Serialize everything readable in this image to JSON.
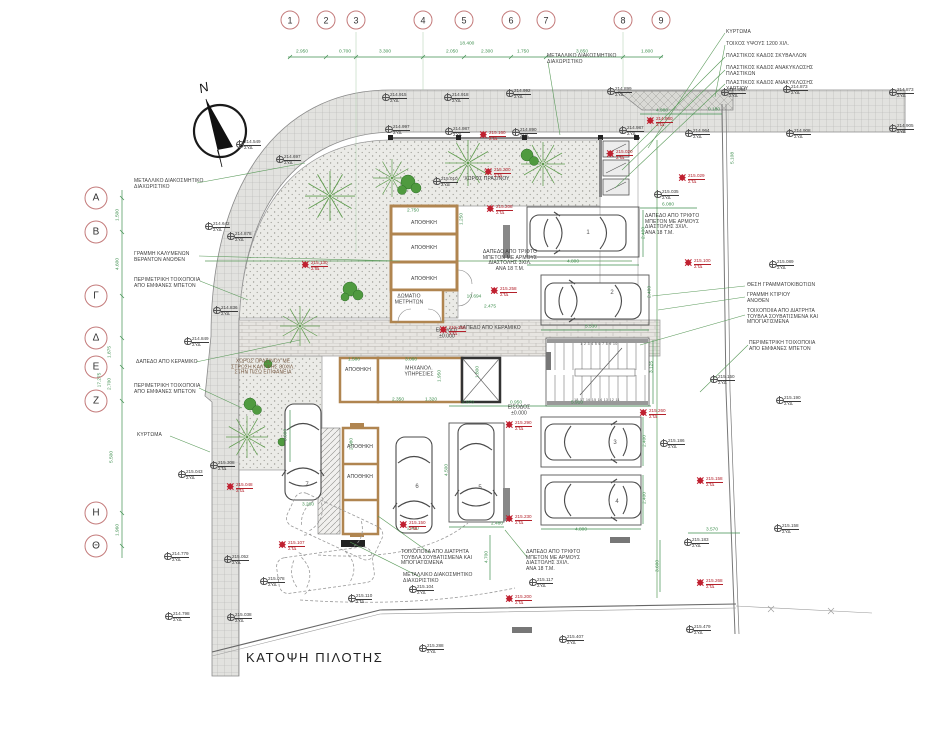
{
  "title": "ΚΑΤΟΨΗ ΠΙΛΟΤΗΣ",
  "north_label": "N",
  "colors": {
    "dim_green": "#3f8f4f",
    "marker_black": "#3a3a3a",
    "marker_red": "#b3202a",
    "bubble_red": "#c47b7b",
    "wall_tan": "#b08550"
  },
  "grid": {
    "top_bubbles": [
      {
        "label": "1",
        "x": 290
      },
      {
        "label": "2",
        "x": 326
      },
      {
        "label": "3",
        "x": 356
      },
      {
        "label": "4",
        "x": 423
      },
      {
        "label": "5",
        "x": 464
      },
      {
        "label": "6",
        "x": 511
      },
      {
        "label": "7",
        "x": 546
      },
      {
        "label": "8",
        "x": 623
      },
      {
        "label": "9",
        "x": 661
      }
    ],
    "left_bubbles": [
      {
        "label": "Α",
        "y": 198
      },
      {
        "label": "Β",
        "y": 232
      },
      {
        "label": "Γ",
        "y": 296
      },
      {
        "label": "Δ",
        "y": 338
      },
      {
        "label": "Ε",
        "y": 367
      },
      {
        "label": "Ζ",
        "y": 401
      },
      {
        "label": "Η",
        "y": 513
      },
      {
        "label": "Θ",
        "y": 546
      }
    ],
    "top_total": {
      "t": "18.400",
      "x": 467,
      "y": 44
    },
    "top_segments": [
      {
        "t": "2.950",
        "x": 302
      },
      {
        "t": "0.700",
        "x": 345
      },
      {
        "t": "3.300",
        "x": 385
      },
      {
        "t": "2.050",
        "x": 452
      },
      {
        "t": "2.300",
        "x": 487
      },
      {
        "t": "1.750",
        "x": 523
      },
      {
        "t": "3.850",
        "x": 582
      },
      {
        "t": "1.800",
        "x": 647
      }
    ],
    "left_total": {
      "t": "17.275",
      "x": 100,
      "y": 380
    },
    "left_segments": [
      {
        "t": "1.500",
        "x": 118,
        "y": 215
      },
      {
        "t": "4.600",
        "x": 118,
        "y": 264
      },
      {
        "t": "1.875",
        "x": 110,
        "y": 352
      },
      {
        "t": "2.700",
        "x": 110,
        "y": 384
      },
      {
        "t": "5.500",
        "x": 112,
        "y": 457
      },
      {
        "t": "1.960",
        "x": 118,
        "y": 530
      }
    ]
  },
  "callouts": [
    {
      "t": "ΜΕΤΑΛΛΙΚΟ ΔΙΑΚΟΣΜΗΤΙΚΟ\nΔΙΑΧΩΡΙΣΤΙΚΟ",
      "x": 134,
      "y": 179
    },
    {
      "t": "ΓΡΑΜΜΗ ΚΑΛΥΜΕΝΩΝ\nΒΕΡΑΝΤΩΝ ΑΝΩΘΕΝ",
      "x": 134,
      "y": 252
    },
    {
      "t": "ΠΕΡΙΜΕΤΡΙΚΗ ΤΟΙΧΟΠΟΙΙΑ\nΑΠΟ ΕΜΦΑΝΕΣ ΜΠΕΤΟΝ",
      "x": 134,
      "y": 278
    },
    {
      "t": "ΔΑΠΕΔΟ ΑΠΟ ΚΕΡΑΜΙΚΟ",
      "x": 136,
      "y": 360
    },
    {
      "t": "ΠΕΡΙΜΕΤΡΙΚΗ ΤΟΙΧΟΠΟΙΙΑ\nΑΠΟ ΕΜΦΑΝΕΣ ΜΠΕΤΟΝ",
      "x": 134,
      "y": 384
    },
    {
      "t": "ΚΥΡΤΩΜΑ",
      "x": 137,
      "y": 433
    },
    {
      "t": "ΜΕΤΑΛΛΙΚΟ ΔΙΑΚΟΣΜΗΤΙΚΟ\nΔΙΑΧΩΡΙΣΤΙΚΟ",
      "x": 547,
      "y": 54
    },
    {
      "t": "ΚΥΡΤΩΜΑ",
      "x": 726,
      "y": 30
    },
    {
      "t": "ΤΟΙΧΟΣ ΥΨΟΥΣ 1200 ΧΙΛ.",
      "x": 726,
      "y": 42
    },
    {
      "t": "ΠΛΑΣΤΙΚΟΣ ΚΑΔΟΣ ΣΚΥΒΑΛΛΩΝ",
      "x": 726,
      "y": 54
    },
    {
      "t": "ΠΛΑΣΤΙΚΟΣ ΚΑΔΟΣ ΑΝΑΚΥΚΛΩΣΗΣ\nΠΛΑΣΤΙΚΩΝ",
      "x": 726,
      "y": 66
    },
    {
      "t": "ΠΛΑΣΤΙΚΟΣ ΚΑΔΟΣ ΑΝΑΚΥΚΛΩΣΗΣ\nΧΑΡΤΙΟΥ",
      "x": 726,
      "y": 81
    },
    {
      "t": "ΔΑΠΕΔΟ ΑΠΟ ΤΡΙΦΤΟ\nΜΠΕΤΟΝ ΜΕ ΑΡΜΟΥΣ\nΔΙΑΣΤΟΛΗΣ 3ΧΙΛ.\nΑΝΑ 18 Τ.Μ.",
      "x": 645,
      "y": 214
    },
    {
      "t": "ΘΕΣΗ ΓΡΑΜΜΑΤΟΚΙΒΩΤΙΩΝ",
      "x": 747,
      "y": 283
    },
    {
      "t": "ΓΡΑΜΜΗ ΚΤΙΡΙΟΥ\nΑΝΩΘΕΝ",
      "x": 747,
      "y": 293
    },
    {
      "t": "ΤΟΙΧΟΠΟΙΙΑ ΑΠΟ ΔΙΑΤΡΗΤΑ\nΤΟΥΒΛΑ ΣΟΥΒΑΤΙΣΜΕΝΑ ΚΑΙ\nΜΠΟΓΙΑΤΙΣΜΕΝΑ",
      "x": 747,
      "y": 309
    },
    {
      "t": "ΠΕΡΙΜΕΤΡΙΚΗ ΤΟΙΧΟΠΟΙΙΑ\nΑΠΟ ΕΜΦΑΝΕΣ ΜΠΕΤΟΝ",
      "x": 749,
      "y": 341
    },
    {
      "t": "ΤΟΙΧΟΠΟΙΙΑ ΑΠΟ ΔΙΑΤΡΗΤΑ\nΤΟΥΒΛΑ ΣΟΥΒΑΤΙΣΜΕΝΑ ΚΑΙ\nΜΠΟΓΙΑΤΙΣΜΕΝΑ",
      "x": 401,
      "y": 550
    },
    {
      "t": "ΜΕΤΑΛΛΙΚΟ ΔΙΑΚΟΣΜΗΤΙΚΟ\nΔΙΑΧΩΡΙΣΤΙΚΟ",
      "x": 403,
      "y": 573
    },
    {
      "t": "ΔΑΠΕΔΟ ΑΠΟ ΤΡΙΦΤΟ\nΜΠΕΤΟΝ ΜΕ ΑΡΜΟΥΣ\nΔΙΑΣΤΟΛΗΣ 3ΧΙΛ.\nΑΝΑ 18 Τ.Μ.",
      "x": 526,
      "y": 550
    }
  ],
  "rooms": [
    {
      "t": "ΑΠΟΘΗΚΗ",
      "x": 424,
      "y": 224
    },
    {
      "t": "ΑΠΟΘΗΚΗ",
      "x": 424,
      "y": 249
    },
    {
      "t": "ΑΠΟΘΗΚΗ",
      "x": 424,
      "y": 280
    },
    {
      "t": "ΔΩΜΑΤΙΟ\nΜΕΤΡΗΤΩΝ",
      "x": 409,
      "y": 300
    },
    {
      "t": "ΑΠΟΘΗΚΗ",
      "x": 358,
      "y": 371
    },
    {
      "t": "ΜΗΧΑΝΟΛ.\nΥΠΗΡΕΣΙΕΣ",
      "x": 419,
      "y": 372
    },
    {
      "t": "ΑΠΟΘΗΚΗ",
      "x": 360,
      "y": 448
    },
    {
      "t": "ΑΠΟΘΗΚΗ",
      "x": 360,
      "y": 478
    },
    {
      "t": "ΧΩΡΟΣ ΠΡΑΣΙΝΟΥ",
      "x": 487,
      "y": 180
    },
    {
      "t": "ΧΩΡΟΣ ΠΡΑΣΙΝΟΥ ΜΕ\nΣΤΡΩΣΗ ΚΑΛΥΨΗΣ 80ΧΙΛ.\nΣΤΗΝ ΠΙΣΩ ΕΠΙΦΑΝΕΙΑ",
      "x": 263,
      "y": 368,
      "cls": "green-note"
    },
    {
      "t": "ΔΑΠΕΔΟ ΑΠΟ ΚΕΡΑΜΙΚΟ",
      "x": 490,
      "y": 329
    },
    {
      "t": "ΔΑΠΕΔΟ ΑΠΟ ΤΡΙΦΤΟ\nΜΠΕΤΟΝ ΜΕ ΑΡΜΟΥΣ\nΔΙΑΣΤΟΛΗΣ 3ΧΙΛ.\nΑΝΑ 18 Τ.Μ.",
      "x": 510,
      "y": 261
    },
    {
      "t": "ΕΙΣΟΔΟΣ\n±0.000",
      "x": 447,
      "y": 334
    },
    {
      "t": "ΕΙΣΟΔΟΣ\n±0.000",
      "x": 519,
      "y": 411
    }
  ],
  "dims": [
    {
      "t": "2.750",
      "x": 413,
      "y": 211
    },
    {
      "t": "1.250",
      "x": 462,
      "y": 219,
      "rot": true
    },
    {
      "t": "4.800",
      "x": 573,
      "y": 262
    },
    {
      "t": "2.400",
      "x": 644,
      "y": 233,
      "rot": true
    },
    {
      "t": "5.530",
      "x": 591,
      "y": 327
    },
    {
      "t": "2.400",
      "x": 650,
      "y": 292,
      "rot": true
    },
    {
      "t": "4.980",
      "x": 662,
      "y": 111
    },
    {
      "t": "0.180",
      "x": 714,
      "y": 110
    },
    {
      "t": "6.080",
      "x": 668,
      "y": 205
    },
    {
      "t": "5.108",
      "x": 733,
      "y": 158,
      "rot": true
    },
    {
      "t": "10.694",
      "x": 474,
      "y": 297
    },
    {
      "t": "2.475",
      "x": 490,
      "y": 307
    },
    {
      "t": "1.580",
      "x": 354,
      "y": 360
    },
    {
      "t": "3.060",
      "x": 411,
      "y": 360
    },
    {
      "t": "1.950",
      "x": 440,
      "y": 376,
      "rot": true
    },
    {
      "t": "1.800",
      "x": 478,
      "y": 372,
      "rot": true
    },
    {
      "t": "2.350",
      "x": 398,
      "y": 400
    },
    {
      "t": "1.320",
      "x": 431,
      "y": 400
    },
    {
      "t": "2.970",
      "x": 468,
      "y": 403
    },
    {
      "t": "0.950",
      "x": 516,
      "y": 403
    },
    {
      "t": "5.910",
      "x": 577,
      "y": 403
    },
    {
      "t": "3.125",
      "x": 652,
      "y": 367,
      "rot": true
    },
    {
      "t": "2.080",
      "x": 352,
      "y": 444,
      "rot": true
    },
    {
      "t": "2.480",
      "x": 497,
      "y": 524
    },
    {
      "t": "4.500",
      "x": 447,
      "y": 470,
      "rot": true
    },
    {
      "t": "4.800",
      "x": 581,
      "y": 530
    },
    {
      "t": "2.400",
      "x": 645,
      "y": 441,
      "rot": true
    },
    {
      "t": "2.400",
      "x": 645,
      "y": 498,
      "rot": true
    },
    {
      "t": "3.600",
      "x": 286,
      "y": 435,
      "rot": true
    },
    {
      "t": "3.280",
      "x": 308,
      "y": 505
    },
    {
      "t": "2.400",
      "x": 413,
      "y": 529
    },
    {
      "t": "3.570",
      "x": 712,
      "y": 530
    },
    {
      "t": "3.600",
      "x": 658,
      "y": 566,
      "rot": true
    },
    {
      "t": "4.700",
      "x": 487,
      "y": 557,
      "rot": true
    }
  ],
  "elevations": [
    {
      "v": "214.549",
      "d": "ΣΥΔ",
      "x": 244,
      "y": 140
    },
    {
      "v": "214.697",
      "d": "ΣΥΔ",
      "x": 284,
      "y": 155
    },
    {
      "v": "214.915",
      "d": "ΣΥΔ",
      "x": 390,
      "y": 93
    },
    {
      "v": "214.918",
      "d": "ΣΥΔ",
      "x": 452,
      "y": 93
    },
    {
      "v": "214.992",
      "d": "ΣΥΔ",
      "x": 514,
      "y": 89
    },
    {
      "v": "214.899",
      "d": "ΣΥΔ",
      "x": 615,
      "y": 87
    },
    {
      "v": "214.983",
      "d": "ΣΥΔ",
      "x": 729,
      "y": 88
    },
    {
      "v": "214.873",
      "d": "ΣΥΔ",
      "x": 791,
      "y": 85
    },
    {
      "v": "214.873",
      "d": "ΣΥΔ",
      "x": 897,
      "y": 88
    },
    {
      "v": "214.997",
      "d": "ΣΥΔ",
      "x": 393,
      "y": 125
    },
    {
      "v": "214.987",
      "d": "ΣΥΔ",
      "x": 453,
      "y": 127
    },
    {
      "v": "215.160",
      "d": "ΣΤΔ",
      "r": 1,
      "x": 489,
      "y": 131
    },
    {
      "v": "214.890",
      "d": "ΣΥΔ",
      "x": 520,
      "y": 128
    },
    {
      "v": "214.987",
      "d": "ΣΥΔ",
      "x": 627,
      "y": 126
    },
    {
      "v": "214.980",
      "d": "ΣΤΔ",
      "r": 1,
      "x": 656,
      "y": 117
    },
    {
      "v": "214.964",
      "d": "ΣΥΔ",
      "x": 693,
      "y": 129
    },
    {
      "v": "214.908",
      "d": "ΣΥΔ",
      "x": 794,
      "y": 129
    },
    {
      "v": "214.905",
      "d": "ΣΥΔ",
      "x": 897,
      "y": 124
    },
    {
      "v": "215.020",
      "d": "ΣΤΔ",
      "r": 1,
      "x": 616,
      "y": 150
    },
    {
      "v": "215.029",
      "d": "ΣΤΔ",
      "r": 1,
      "x": 688,
      "y": 174
    },
    {
      "v": "215.035",
      "d": "ΣΥΔ",
      "x": 662,
      "y": 190
    },
    {
      "v": "215.010",
      "d": "ΣΥΔ",
      "x": 441,
      "y": 177
    },
    {
      "v": "215.200",
      "d": "ΣΤΔ",
      "r": 1,
      "x": 494,
      "y": 168
    },
    {
      "v": "215.089",
      "d": "ΣΥΔ",
      "x": 777,
      "y": 260
    },
    {
      "v": "215.100",
      "d": "ΣΤΔ",
      "r": 1,
      "x": 694,
      "y": 259
    },
    {
      "v": "214.642",
      "d": "ΣΥΔ",
      "x": 213,
      "y": 222
    },
    {
      "v": "214.878",
      "d": "ΣΥΔ",
      "x": 235,
      "y": 232
    },
    {
      "v": "214.836",
      "d": "ΣΥΔ",
      "x": 221,
      "y": 306
    },
    {
      "v": "214.849",
      "d": "ΣΥΔ",
      "x": 192,
      "y": 337
    },
    {
      "v": "215.130",
      "d": "ΣΤΔ",
      "r": 1,
      "x": 311,
      "y": 261
    },
    {
      "v": "215.043",
      "d": "ΣΥΔ",
      "x": 186,
      "y": 470
    },
    {
      "v": "215.308",
      "d": "ΣΤΔ",
      "x": 218,
      "y": 461
    },
    {
      "v": "215.048",
      "d": "ΣΤΔ",
      "r": 1,
      "x": 236,
      "y": 483
    },
    {
      "v": "215.107",
      "d": "ΣΤΔ",
      "r": 1,
      "x": 288,
      "y": 541
    },
    {
      "v": "214.779",
      "d": "ΣΥΔ",
      "x": 172,
      "y": 552
    },
    {
      "v": "215.052",
      "d": "ΣΥΔ",
      "x": 232,
      "y": 555
    },
    {
      "v": "215.078",
      "d": "ΣΥΔ",
      "x": 268,
      "y": 577
    },
    {
      "v": "214.798",
      "d": "ΣΥΔ",
      "x": 173,
      "y": 612
    },
    {
      "v": "215.038",
      "d": "ΣΥΔ",
      "x": 235,
      "y": 613
    },
    {
      "v": "215.208",
      "d": "ΣΤΔ",
      "r": 1,
      "x": 496,
      "y": 205
    },
    {
      "v": "215.258",
      "d": "ΣΤΔ",
      "r": 1,
      "x": 500,
      "y": 287
    },
    {
      "v": "215.250",
      "d": "ΣΤΔ",
      "r": 1,
      "x": 449,
      "y": 326
    },
    {
      "v": "215.150",
      "d": "ΣΤΔ",
      "r": 1,
      "x": 409,
      "y": 521
    },
    {
      "v": "215.290",
      "d": "ΣΤΔ",
      "r": 1,
      "x": 515,
      "y": 421
    },
    {
      "v": "215.230",
      "d": "ΣΤΔ",
      "r": 1,
      "x": 515,
      "y": 515
    },
    {
      "v": "215.260",
      "d": "ΣΤΔ",
      "r": 1,
      "x": 649,
      "y": 409
    },
    {
      "v": "215.150",
      "d": "ΣΥΔ",
      "x": 718,
      "y": 375
    },
    {
      "v": "215.186",
      "d": "ΣΥΔ",
      "x": 668,
      "y": 439
    },
    {
      "v": "215.190",
      "d": "ΣΥΔ",
      "x": 784,
      "y": 396
    },
    {
      "v": "215.158",
      "d": "ΣΤΔ",
      "r": 1,
      "x": 706,
      "y": 477
    },
    {
      "v": "215.158",
      "d": "ΣΥΔ",
      "x": 782,
      "y": 524
    },
    {
      "v": "215.183",
      "d": "ΣΥΔ",
      "x": 692,
      "y": 538
    },
    {
      "v": "215.268",
      "d": "ΣΤΔ",
      "r": 1,
      "x": 706,
      "y": 579
    },
    {
      "v": "215.479",
      "d": "ΣΥΔ",
      "x": 694,
      "y": 625
    },
    {
      "v": "215.104",
      "d": "ΣΥΔ",
      "x": 417,
      "y": 585
    },
    {
      "v": "215.110",
      "d": "ΣΤΔ",
      "x": 356,
      "y": 594
    },
    {
      "v": "215.117",
      "d": "ΣΥΔ",
      "x": 537,
      "y": 578
    },
    {
      "v": "215.200",
      "d": "ΣΤΔ",
      "r": 1,
      "x": 515,
      "y": 595
    },
    {
      "v": "215.288",
      "d": "ΣΥΔ",
      "x": 427,
      "y": 644
    },
    {
      "v": "215.407",
      "d": "ΣΥΔ",
      "x": 567,
      "y": 635
    }
  ],
  "parking_numbers": [
    {
      "n": "1",
      "x": 588,
      "y": 233
    },
    {
      "n": "2",
      "x": 612,
      "y": 293
    },
    {
      "n": "3",
      "x": 615,
      "y": 443
    },
    {
      "n": "4",
      "x": 617,
      "y": 502
    },
    {
      "n": "5",
      "x": 480,
      "y": 488
    },
    {
      "n": "6",
      "x": 417,
      "y": 487
    },
    {
      "n": "7",
      "x": 307,
      "y": 485
    }
  ],
  "stair_numbers": [
    {
      "t": "1 2 3 4 5 6 7 8 9 10",
      "x": 599,
      "y": 344
    },
    {
      "t": "18 17 16 15 14 13 12 11",
      "x": 597,
      "y": 400
    }
  ]
}
